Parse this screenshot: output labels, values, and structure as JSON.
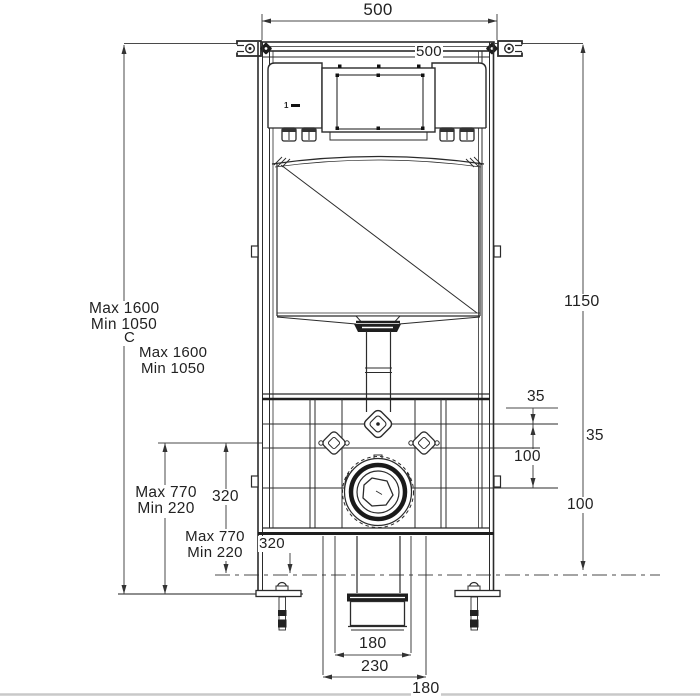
{
  "title": "Concealed WC cistern frame - installation dimension drawing",
  "colors": {
    "line": "#2b2b2b",
    "dim_line": "#4a4a4a",
    "text": "#222222",
    "divider": "#c9c9c9"
  },
  "labels": {
    "dim_top_width": "500",
    "dim_top_width_echo": "500",
    "dim_right_height": "1150",
    "dim_frame_max": "Max 1600",
    "dim_frame_min": "Min 1050",
    "section_mark": "C",
    "dim_frame_max_echo": "Max 1600",
    "dim_frame_min_echo": "Min 1050",
    "dim_offset_35": "35",
    "dim_offset_35_echo": "35",
    "dim_offset_100": "100",
    "dim_offset_100_echo": "100",
    "dim_pan_max": "Max 770",
    "dim_pan_min": "Min 220",
    "dim_pan_max_echo": "Max 770",
    "dim_pan_min_echo": "Min 220",
    "dim_outlet_320": "320",
    "dim_outlet_320_echo": "320",
    "dim_outlet_180": "180",
    "dim_bolts_230": "230",
    "dim_bottom_180_echo": "180",
    "flush_unit_mark": "1"
  }
}
